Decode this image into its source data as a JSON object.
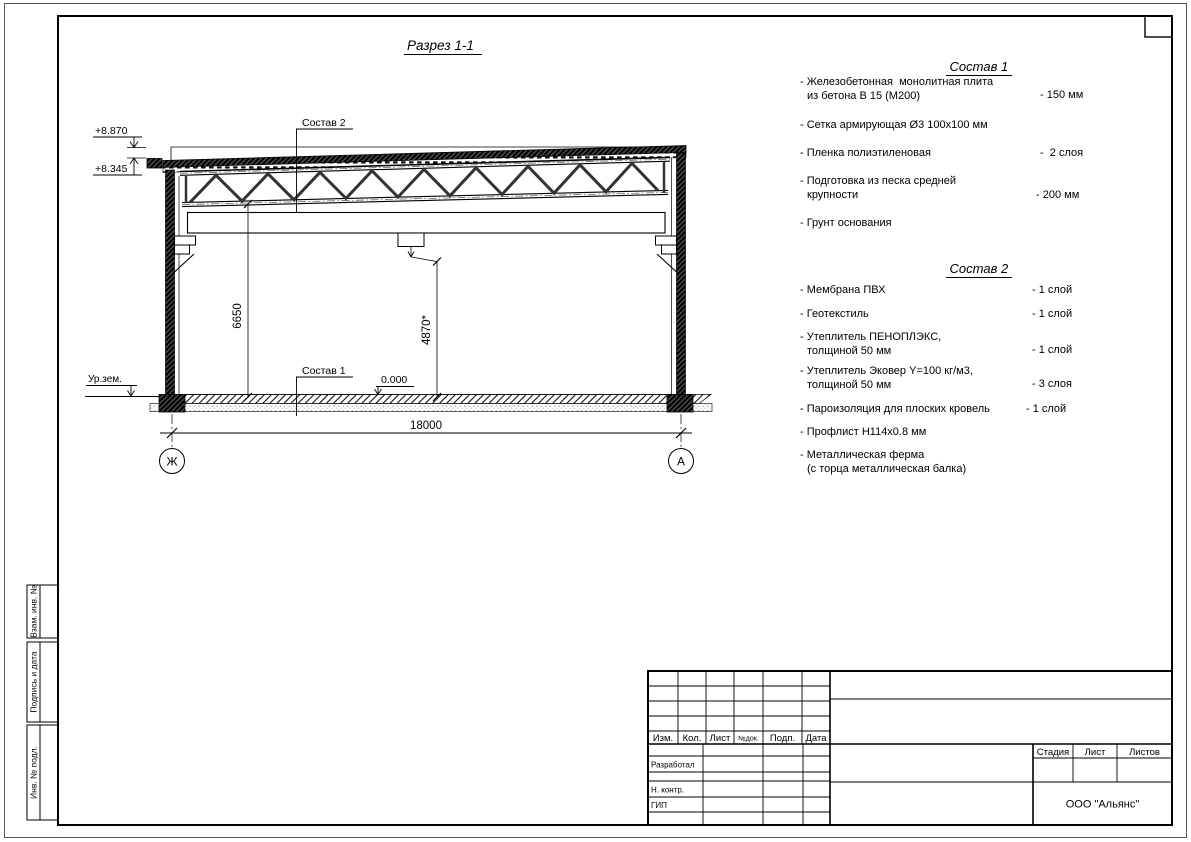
{
  "drawing": {
    "title": "Разрез 1-1",
    "elev_top": "+8.870",
    "elev_eaves": "+8.345",
    "dim_height": "6650",
    "dim_clear": "4870*",
    "dim_span": "18000",
    "level_zero": "0.000",
    "ground": "Ур.зем.",
    "leader1": "Состав 1",
    "leader2": "Состав 2",
    "axis_left": "Ж",
    "axis_right": "А"
  },
  "specs": {
    "s1": {
      "title": "Состав 1",
      "items": [
        {
          "l1": "- Железобетонная  монолитная плита",
          "l2": "из бетона В 15 (М200)",
          "val": "- 150 мм"
        },
        {
          "l1": "- Сетка армирующая Ø3 100х100 мм",
          "l2": "",
          "val": ""
        },
        {
          "l1": "- Пленка полиэтиленовая",
          "l2": "",
          "val": "-  2 слоя"
        },
        {
          "l1": "- Подготовка из песка средней",
          "l2": "крупности",
          "val": "- 200 мм"
        },
        {
          "l1": "- Грунт основания",
          "l2": "",
          "val": ""
        }
      ]
    },
    "s2": {
      "title": "Состав 2",
      "items": [
        {
          "l1": "- Мембрана ПВХ",
          "l2": "",
          "val": "- 1 слой"
        },
        {
          "l1": "- Геотекстиль",
          "l2": "",
          "val": "- 1 слой"
        },
        {
          "l1": "- Утеплитель ПЕНОПЛЭКС,",
          "l2": "толщиной 50 мм",
          "val": "- 1 слой"
        },
        {
          "l1": "- Утеплитель Эковер Y=100 кг/м3,",
          "l2": "толщиной 50 мм",
          "val": "- 3 слоя"
        },
        {
          "l1": "- Пароизоляция для плоских кровель",
          "l2": "",
          "val": "- 1 слой"
        },
        {
          "l1": "- Профлист Н114х0.8 мм",
          "l2": "",
          "val": ""
        },
        {
          "l1": "- Металлическая ферма",
          "l2": "(с торца металлическая балка)",
          "val": ""
        }
      ]
    }
  },
  "title_block": {
    "cols": [
      "Изм.",
      "Кол.",
      "Лист",
      "№док.",
      "Подп.",
      "Дата"
    ],
    "roles": [
      "Разработал",
      "Н. контр.",
      "ГИП"
    ],
    "stage": [
      "Стадия",
      "Лист",
      "Листов"
    ],
    "company": "ООО \"Альянс\""
  },
  "side_strip": {
    "box1": "Взам. инв. №",
    "box2": "Подпись и дата",
    "box3": "Инв. № подл."
  }
}
